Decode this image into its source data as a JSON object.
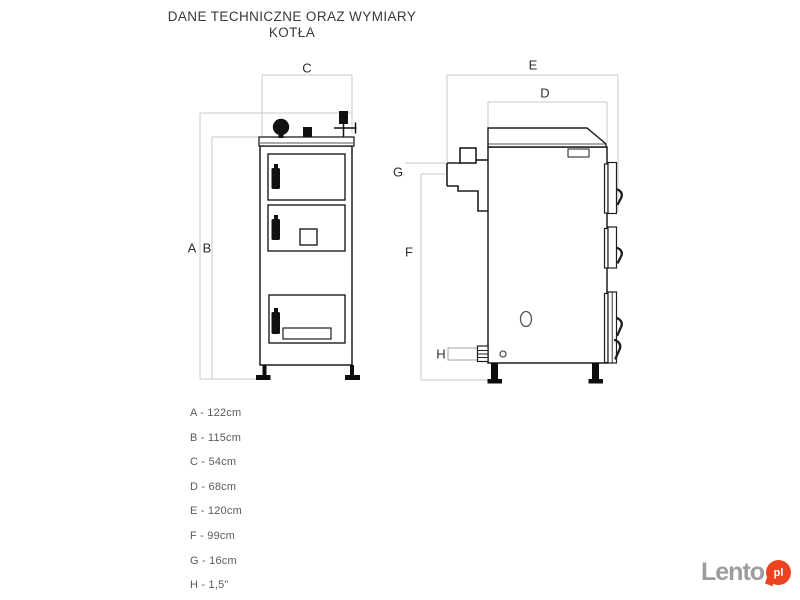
{
  "title": {
    "line1": "DANE TECHNICZNE ORAZ WYMIARY",
    "line2": "KOTŁA"
  },
  "diagram": {
    "front_view_labels": {
      "a": "A",
      "b": "B",
      "c": "C"
    },
    "side_view_labels": {
      "d": "D",
      "e": "E",
      "f": "F",
      "g": "G",
      "h": "H"
    }
  },
  "legend": {
    "items": [
      "A - 122cm",
      "B - 115cm",
      "C - 54cm",
      "D - 68cm",
      "E - 120cm",
      "F - 99cm",
      "G - 16cm",
      "H - 1,5\""
    ]
  },
  "watermark": {
    "brand": "Lento",
    "suffix": "pl"
  },
  "colors": {
    "line": "#1e1e1e",
    "dim_line": "#c9c9c9",
    "title_text": "#3a3a3a",
    "legend_text": "#5a5a5a",
    "watermark_gray": "#9d9d9d",
    "watermark_red": "#ec4220"
  }
}
